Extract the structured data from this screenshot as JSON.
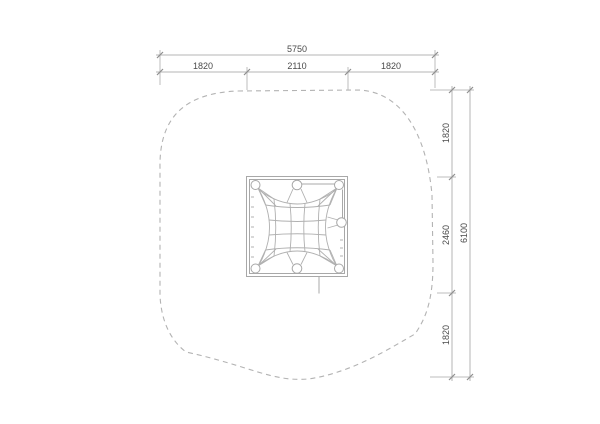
{
  "drawing": {
    "description": "plan view technical drawing of square climbing-net frame with dashed safety zone boundary",
    "colors": {
      "background": "#ffffff",
      "drawing_lines": "#a8a8a8",
      "dimension_lines": "#b4b4b4",
      "dimension_text": "#4a4a4a"
    },
    "top_dimensions": {
      "total": "5750",
      "segments": [
        "1820",
        "2110",
        "1820"
      ]
    },
    "right_dimensions": {
      "total": "6100",
      "segments": [
        "1820",
        "2460",
        "1820"
      ]
    }
  }
}
